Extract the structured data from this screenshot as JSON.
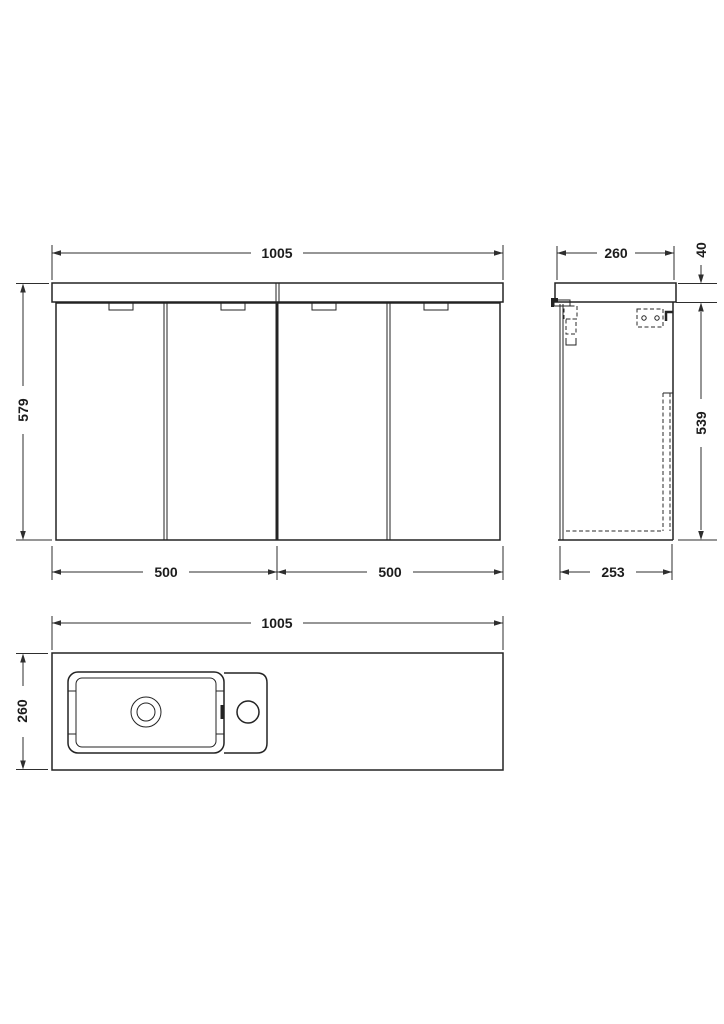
{
  "page": {
    "background": "#ffffff",
    "line_color": "#232323",
    "text_color": "#1c1c1c"
  },
  "views": {
    "front": {
      "name": "front-elevation",
      "dims": {
        "overall_width": "1005",
        "overall_height": "579",
        "left_unit_width": "500",
        "right_unit_width": "500"
      }
    },
    "side": {
      "name": "side-elevation",
      "dims": {
        "overall_depth": "260",
        "worktop_thickness": "40",
        "cabinet_height": "539",
        "cabinet_depth": "253"
      }
    },
    "plan": {
      "name": "plan-view",
      "dims": {
        "overall_width": "1005",
        "overall_depth": "260"
      }
    }
  }
}
